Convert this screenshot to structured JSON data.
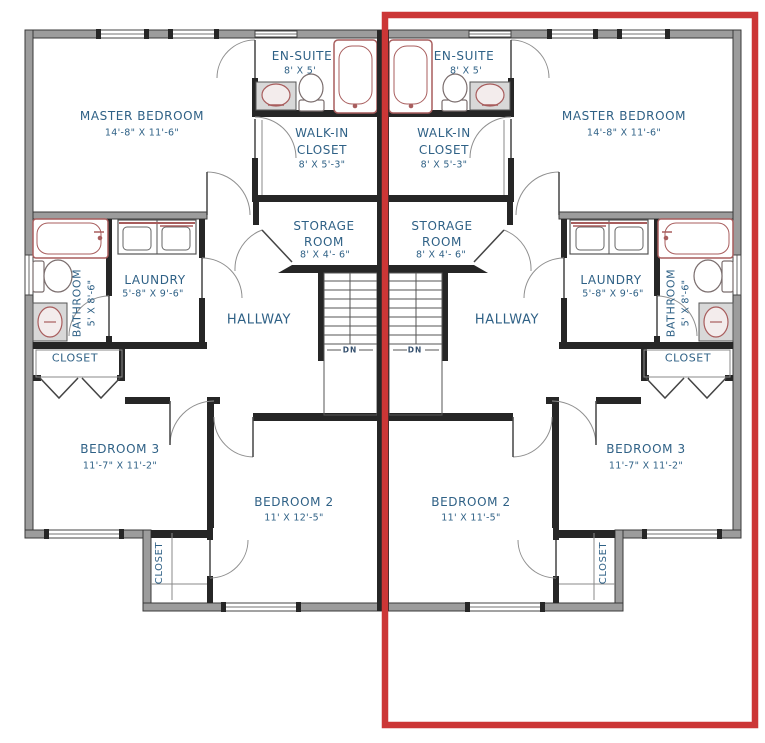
{
  "colors": {
    "label_text": "#2f6186",
    "exterior_wall": "#9c9c9c",
    "interior_wall": "#262626",
    "fixture_accent": "#a85d5d",
    "highlight_box": "#cc3636"
  },
  "units": {
    "left": {
      "master_bedroom": {
        "name": "MASTER BEDROOM",
        "dims": "14'-8\" X 11'-6\""
      },
      "ensuite": {
        "name": "EN-SUITE",
        "dims": "8' X 5'"
      },
      "walkin_closet": {
        "name_line1": "WALK-IN",
        "name_line2": "CLOSET",
        "dims": "8' X 5'-3\""
      },
      "storage_room": {
        "name_line1": "STORAGE",
        "name_line2": "ROOM",
        "dims": "8' X 4'- 6\""
      },
      "laundry": {
        "name": "LAUNDRY",
        "dims": "5'-8\" X 9'-6\""
      },
      "bathroom": {
        "name": "BATHROOM",
        "dims": "5' X 8'-6\""
      },
      "hallway": {
        "name": "HALLWAY"
      },
      "hall_closet": {
        "name": "CLOSET"
      },
      "bedroom3": {
        "name": "BEDROOM 3",
        "dims": "11'-7\" X 11'-2\""
      },
      "bedroom2": {
        "name": "BEDROOM 2",
        "dims": "11' X 12'-5\""
      },
      "bedroom2_closet": {
        "name": "CLOSET"
      },
      "stairs": {
        "label": "DN"
      }
    },
    "right": {
      "master_bedroom": {
        "name": "MASTER BEDROOM",
        "dims": "14'-8\" X 11'-6\""
      },
      "ensuite": {
        "name": "EN-SUITE",
        "dims": "8' X 5'"
      },
      "walkin_closet": {
        "name_line1": "WALK-IN",
        "name_line2": "CLOSET",
        "dims": "8' X 5'-3\""
      },
      "storage_room": {
        "name_line1": "STORAGE",
        "name_line2": "ROOM",
        "dims": "8' X 4'- 6\""
      },
      "laundry": {
        "name": "LAUNDRY",
        "dims": "5'-8\" X 9'-6\""
      },
      "bathroom": {
        "name": "BATHROOM",
        "dims": "5' X 8'-6\""
      },
      "hallway": {
        "name": "HALLWAY"
      },
      "hall_closet": {
        "name": "CLOSET"
      },
      "bedroom3": {
        "name": "BEDROOM 3",
        "dims": "11'-7\" X 11'-2\""
      },
      "bedroom2": {
        "name": "BEDROOM 2",
        "dims": "11' X 11'-5\""
      },
      "bedroom2_closet": {
        "name": "CLOSET"
      },
      "stairs": {
        "label": "DN"
      }
    }
  }
}
